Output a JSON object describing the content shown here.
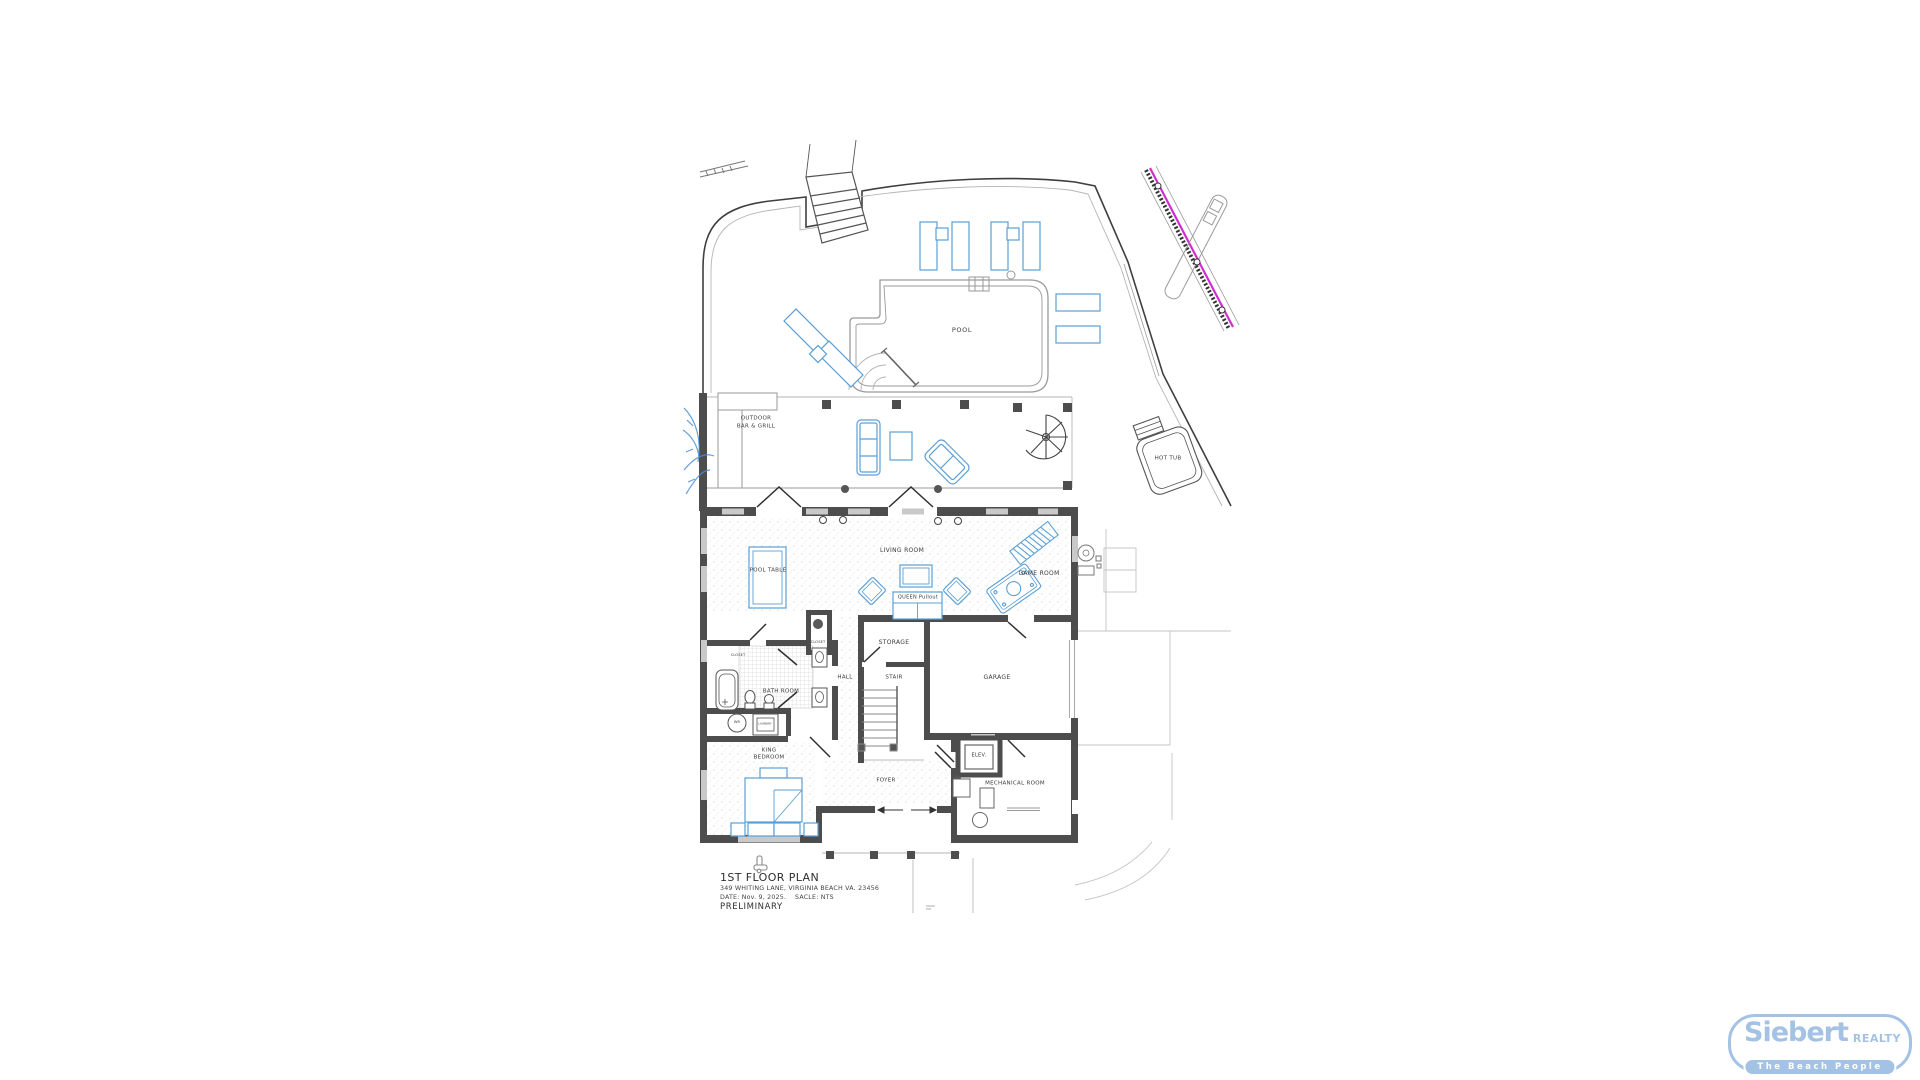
{
  "title_block": {
    "title": "1ST FLOOR PLAN",
    "address": "349 WHITING LANE, VIRGINIA BEACH VA. 23456",
    "date_label": "DATE:  Nov. 9, 2025.",
    "scale_label": "SACLE: NTS",
    "status": "PRELIMINARY"
  },
  "plan": {
    "labels": {
      "pool": "POOL",
      "outdoor_line1": "OUTDOOR",
      "outdoor_line2": "BAR & GRILL",
      "hot_tub": "HOT TUB",
      "living_room": "LIVING ROOM",
      "pool_table": "POOL TABLE",
      "game_room": "GAME ROOM",
      "queen_pullout": "QUEEN Pullout",
      "storage": "STORAGE",
      "closet_a": "CLOSET",
      "closet_b": "CLOSET",
      "bath_room": "BATH ROOM",
      "hall": "HALL",
      "stair": "STAIR",
      "garage": "GARAGE",
      "king_line1": "KING",
      "king_line2": "BEDROOM",
      "foyer": "FOYER",
      "elev": "ELEV.",
      "mechanical_room": "MECHANICAL ROOM",
      "washer": "WR",
      "laundry": "LAUNDRY"
    }
  },
  "logo": {
    "brand": "Siebert",
    "realty": "REALTY",
    "tagline": "The Beach People"
  },
  "colors": {
    "furniture_blue": "#5b9fd6",
    "wall_gray": "#4d4d4d",
    "boundary_magenta": "#cf2fd0",
    "logo_blue": "#a4c2e4"
  }
}
